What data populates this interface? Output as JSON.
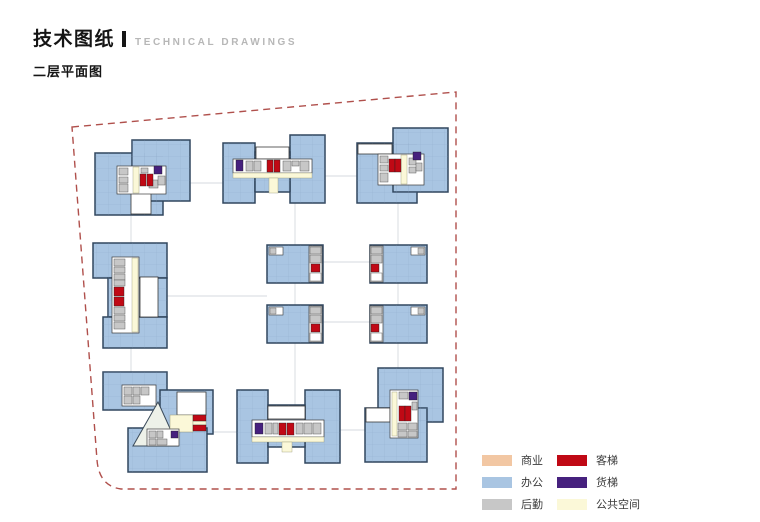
{
  "header": {
    "title_zh": "技术图纸",
    "title_en": "TECHNICAL  DRAWINGS",
    "subtitle": "二层平面图"
  },
  "colors": {
    "commercial": "#f2c7a3",
    "office": "#a9c5e2",
    "logistics": "#c7c7c7",
    "passenger": "#c00915",
    "freight": "#46217e",
    "public": "#fbf8d8",
    "boundary": "#b0504c",
    "outline": "#31465e",
    "grid_line": "#7f9bbc",
    "atrium": "#edf1e9"
  },
  "legend": {
    "items": [
      {
        "id": "commercial",
        "label": "商业"
      },
      {
        "id": "office",
        "label": "办公"
      },
      {
        "id": "logistics",
        "label": "后勤"
      },
      {
        "id": "passenger",
        "label": "客梯"
      },
      {
        "id": "freight",
        "label": "货梯"
      },
      {
        "id": "public",
        "label": "公共空间"
      }
    ]
  }
}
